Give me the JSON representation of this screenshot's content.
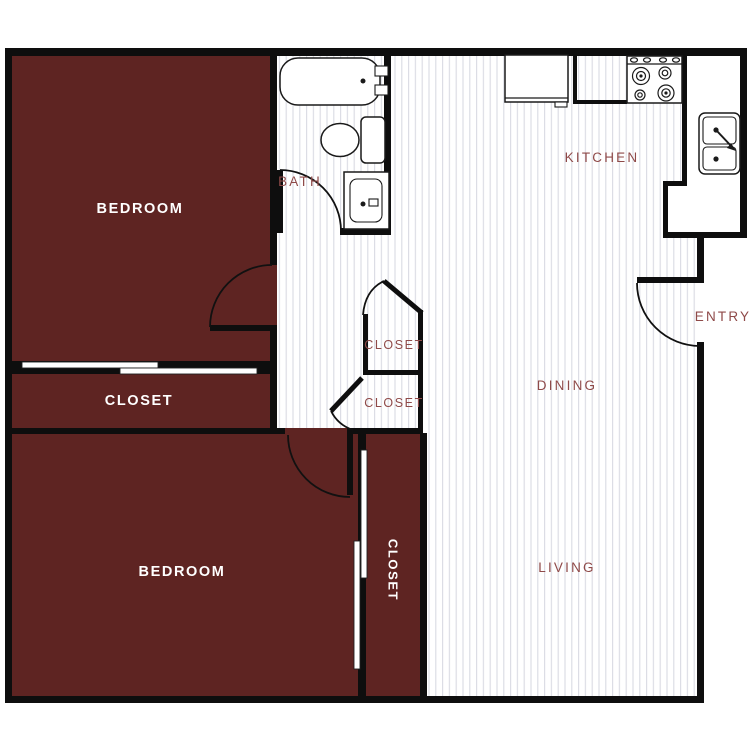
{
  "plan": {
    "type": "apartment-floor-plan",
    "colors": {
      "room_fill": "#5e2422",
      "wall": "#0e0e0e",
      "label_red": "#8f4a49",
      "label_white": "#ffffff",
      "hatch_line": "#d9dbe3",
      "background": "#ffffff"
    },
    "rooms": [
      {
        "id": "bedroom-1",
        "label": "BEDROOM"
      },
      {
        "id": "closet-bedroom-1",
        "label": "CLOSET"
      },
      {
        "id": "bedroom-2",
        "label": "BEDROOM"
      },
      {
        "id": "closet-bedroom-2",
        "label": "CLOSET"
      },
      {
        "id": "bath",
        "label": "BATH"
      },
      {
        "id": "kitchen",
        "label": "KITCHEN"
      },
      {
        "id": "hall-closet-upper",
        "label": "CLOSET"
      },
      {
        "id": "hall-closet-lower",
        "label": "CLOSET"
      },
      {
        "id": "dining",
        "label": "DINING"
      },
      {
        "id": "living",
        "label": "LIVING"
      },
      {
        "id": "entry",
        "label": "ENTRY"
      }
    ],
    "fixtures": [
      "bathtub",
      "toilet",
      "bath-sink-vanity",
      "refrigerator",
      "stove-4-burner",
      "kitchen-double-sink",
      "sliding-closet-doors-bedroom-1",
      "sliding-closet-doors-bedroom-2",
      "swing-door-bedroom-1",
      "swing-door-bedroom-2",
      "swing-door-bath",
      "swing-door-entry",
      "swing-door-hall-closet-upper",
      "swing-door-hall-closet-lower"
    ]
  }
}
